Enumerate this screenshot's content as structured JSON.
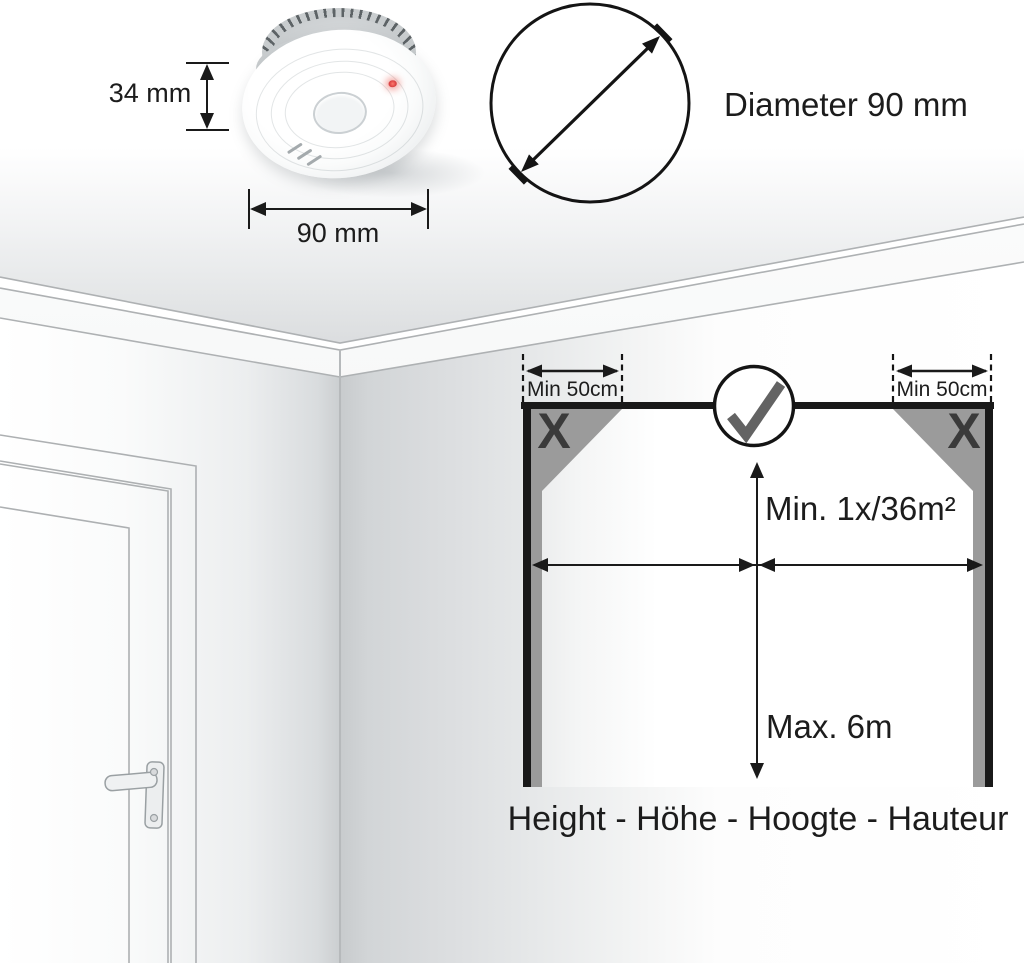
{
  "dimension_diagram": {
    "height_label": "34 mm",
    "width_label": "90 mm"
  },
  "diameter_diagram": {
    "label": "Diameter 90 mm"
  },
  "installation_diagram": {
    "clearance_left_label": "Min 50cm",
    "clearance_right_label": "Min 50cm",
    "wrong_zone_left": "X",
    "wrong_zone_right": "X",
    "coverage_label": "Min. 1x/36m²",
    "max_height_label": "Max. 6m",
    "caption": "Height - Höhe - Hoogte - Hauteur",
    "colors": {
      "line": "#191919",
      "no_mount_zone": "#9b9b9b",
      "checkmark": "#636363"
    }
  },
  "detector": {
    "colors": {
      "led": "#d84040",
      "body": "#fbfcfc",
      "base": "#c8ccce"
    }
  }
}
